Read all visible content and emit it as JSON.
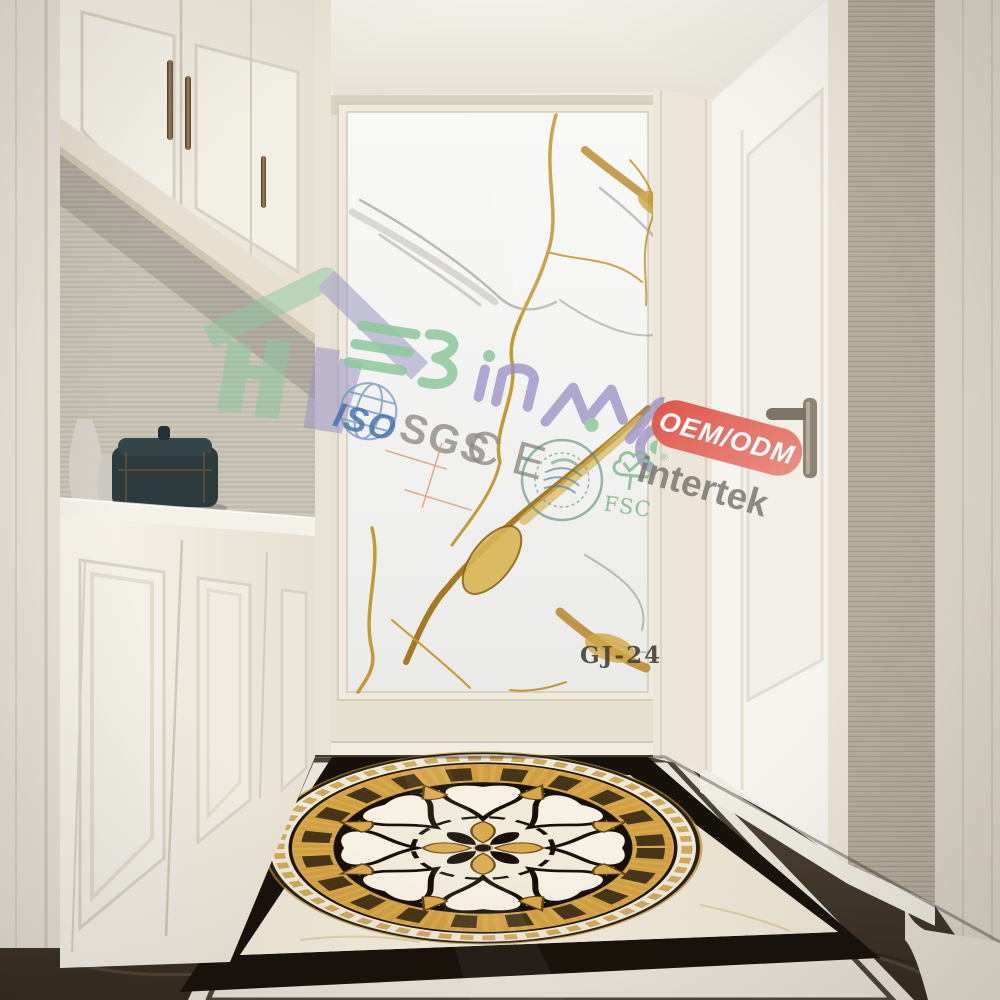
{
  "product": {
    "code_label": "GJ-24"
  },
  "brand": {
    "wordmark": "BINMAO",
    "logo_green": "#8cc89c",
    "logo_purple": "#9a92c6"
  },
  "watermarks": {
    "iso": "ISO",
    "sgs": "SGS",
    "ce": "CE",
    "fsc": "FSC",
    "fsc_reg": "®",
    "intertek": "intertek",
    "oem_odm": "OEM/ODM"
  },
  "palette": {
    "iso_blue": "#3f6fae",
    "cert_gray": "#8f8b84",
    "fsc_green": "#7fb58a",
    "oem_red": "#dd4f42",
    "marble_gold_vein": "#c49a35",
    "marble_gray_vein": "#9b9a96",
    "medallion_gold": "#d8a84c",
    "medallion_black": "#17100a",
    "floor_cream": "#ece4d1",
    "floor_emperador": "#3c332a",
    "cabinet_white": "#f6f3eb"
  }
}
